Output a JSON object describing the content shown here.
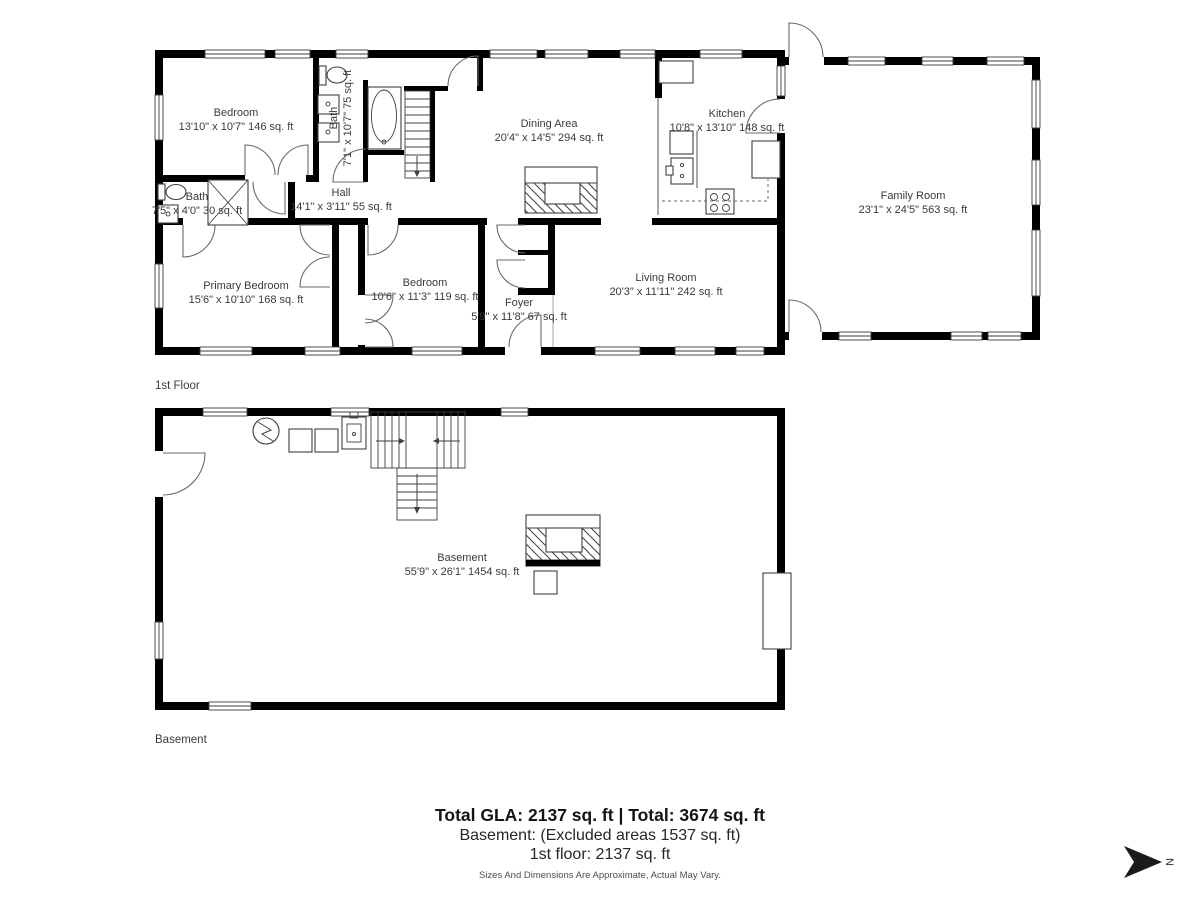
{
  "floors": {
    "first": {
      "label": "1st Floor",
      "rooms": {
        "bedroom1": {
          "name": "Bedroom",
          "dims": "13'10\" x 10'7\" 146 sq. ft"
        },
        "bath1": {
          "name": "Bath",
          "dims": "7'1\" x 10'7\" 75 sq. ft"
        },
        "bath2": {
          "name": "Bath",
          "dims": "7'5\" x 4'0\" 30 sq. ft"
        },
        "hall": {
          "name": "Hall",
          "dims": "14'1\" x 3'11\" 55 sq. ft"
        },
        "dining": {
          "name": "Dining Area",
          "dims": "20'4\" x 14'5\" 294 sq. ft"
        },
        "kitchen": {
          "name": "Kitchen",
          "dims": "10'8\" x 13'10\" 148 sq. ft"
        },
        "family": {
          "name": "Family Room",
          "dims": "23'1\" x 24'5\" 563 sq. ft"
        },
        "primary": {
          "name": "Primary Bedroom",
          "dims": "15'6\" x 10'10\" 168 sq. ft"
        },
        "bedroom2": {
          "name": "Bedroom",
          "dims": "10'6\" x 11'3\" 119 sq. ft"
        },
        "foyer": {
          "name": "Foyer",
          "dims": "5'9\" x 11'8\" 67 sq. ft"
        },
        "living": {
          "name": "Living Room",
          "dims": "20'3\" x 11'11\" 242 sq. ft"
        }
      }
    },
    "basement": {
      "label": "Basement",
      "rooms": {
        "basement": {
          "name": "Basement",
          "dims": "55'9\" x 26'1\" 1454 sq. ft"
        }
      }
    }
  },
  "summary": {
    "totals": "Total GLA: 2137 sq. ft | Total: 3674 sq. ft",
    "basement_line": "Basement: (Excluded areas 1537 sq. ft)",
    "first_floor_line": "1st floor: 2137 sq. ft",
    "disclaimer": "Sizes And Dimensions Are Approximate, Actual May Vary."
  },
  "compass": {
    "label": "N"
  },
  "colors": {
    "wall": "#000000",
    "text": "#3a3a3a"
  }
}
